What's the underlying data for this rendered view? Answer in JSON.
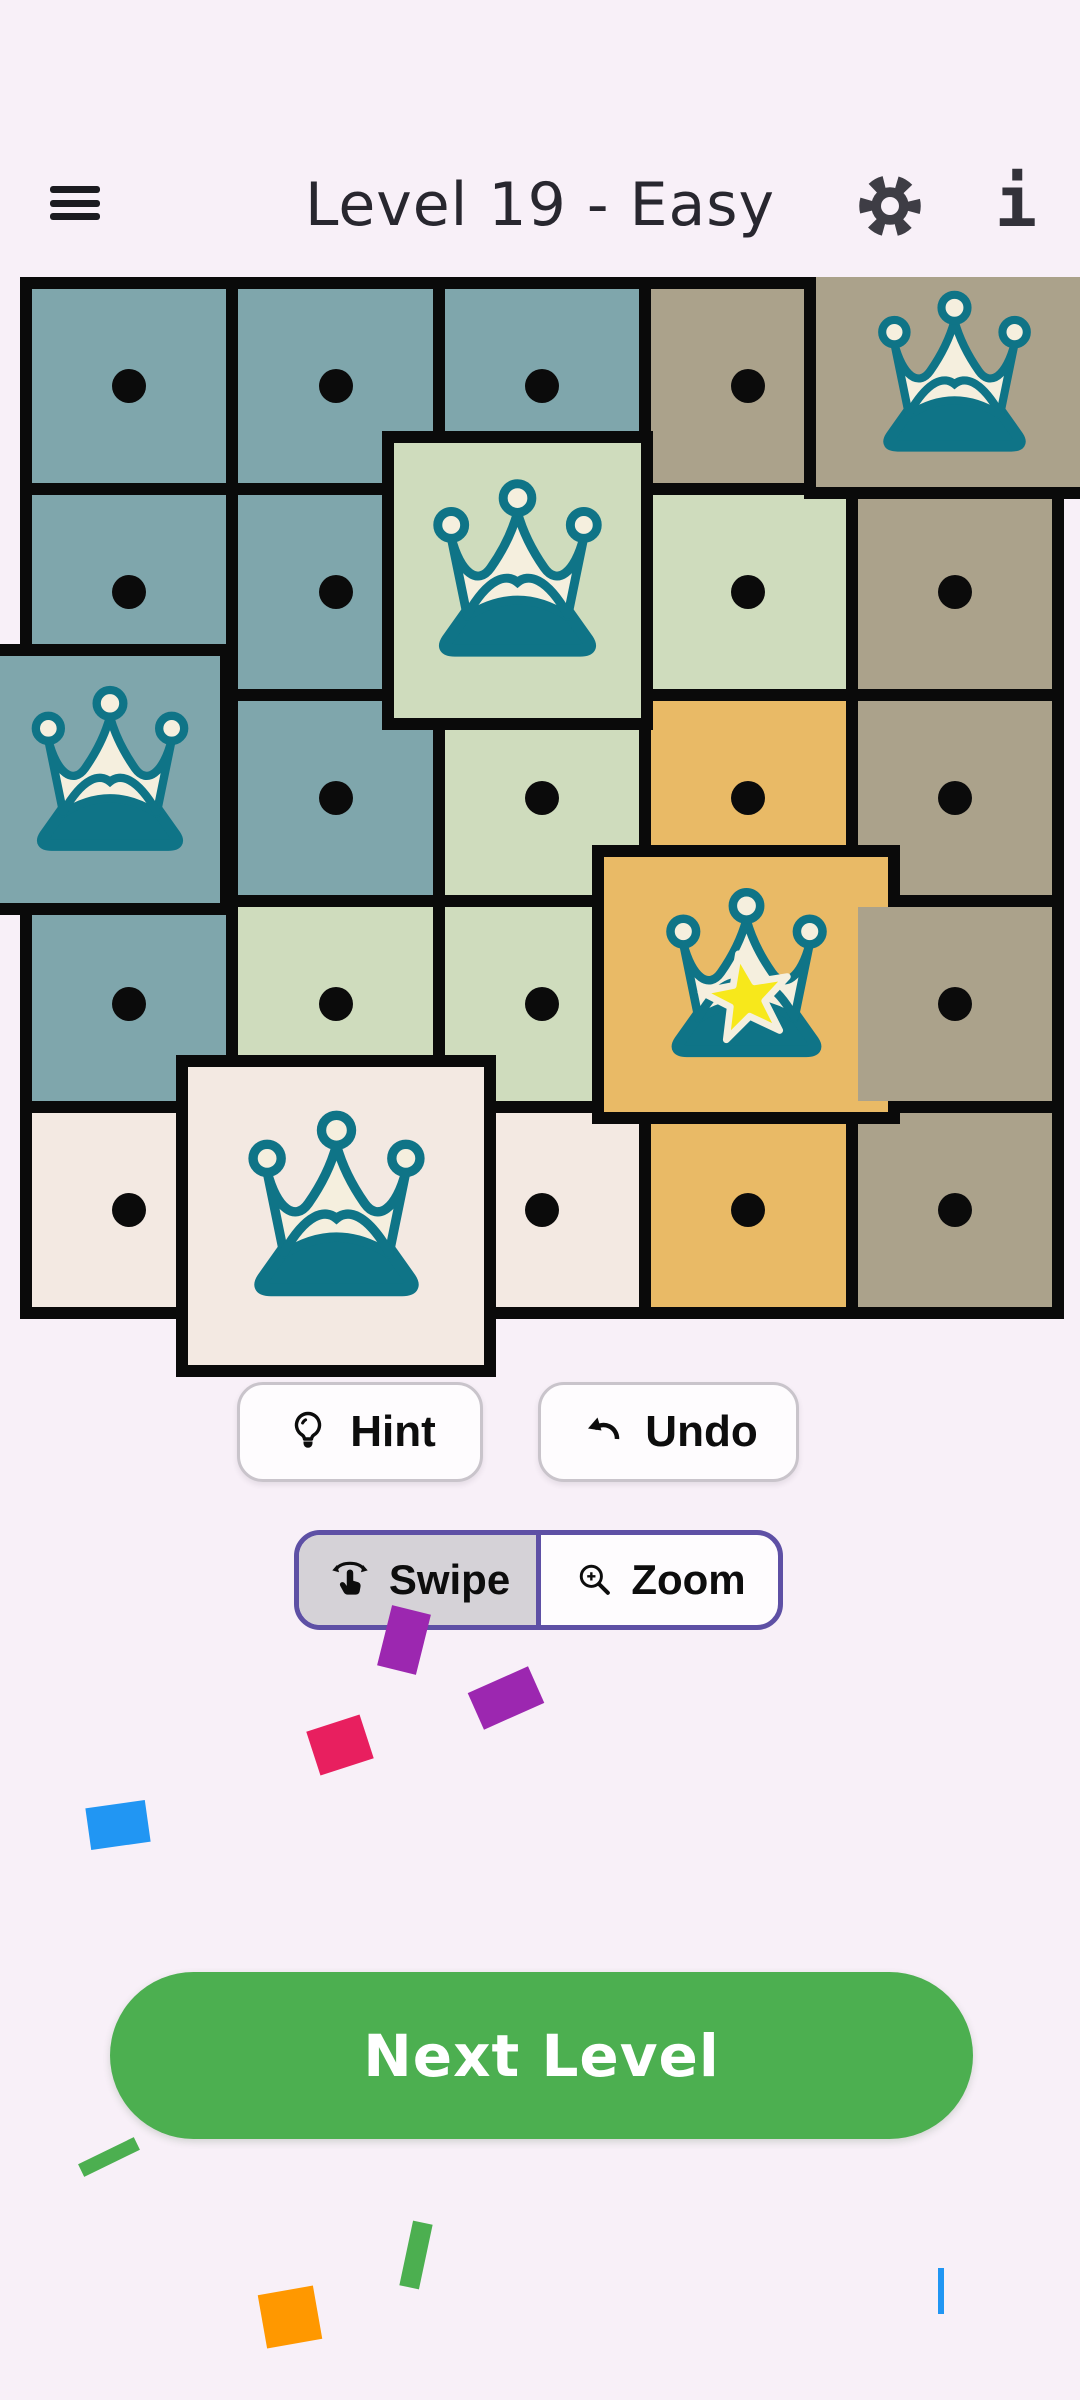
{
  "header": {
    "title": "Level 19 - Easy",
    "menu_icon": "hamburger-icon",
    "settings_icon": "gear-icon",
    "info_icon": "info-icon",
    "info_glyph": "i"
  },
  "theme": {
    "background": "#F8F0F8",
    "board_black": "#0A0A0A",
    "icon_teal": "#0F7487",
    "icon_cream": "#F5EFDE",
    "star_yellow": "#F7E81B",
    "cell_colors": {
      "blue": "#7FA6AC",
      "green": "#CFDCBD",
      "taupe": "#ABA28B",
      "orange": "#E9BA66",
      "cream": "#F3E9E2"
    }
  },
  "board": {
    "rows": 5,
    "cols": 5,
    "cells": [
      {
        "r": 0,
        "c": 0,
        "color": "blue",
        "marker": "dot"
      },
      {
        "r": 0,
        "c": 1,
        "color": "blue",
        "marker": "dot"
      },
      {
        "r": 0,
        "c": 2,
        "color": "blue",
        "marker": "dot"
      },
      {
        "r": 0,
        "c": 3,
        "color": "taupe",
        "marker": "dot"
      },
      {
        "r": 0,
        "c": 4,
        "color": "taupe",
        "marker": "crown"
      },
      {
        "r": 1,
        "c": 0,
        "color": "blue",
        "marker": "dot"
      },
      {
        "r": 1,
        "c": 1,
        "color": "blue",
        "marker": "dot"
      },
      {
        "r": 1,
        "c": 2,
        "color": "green",
        "marker": "crown"
      },
      {
        "r": 1,
        "c": 3,
        "color": "green",
        "marker": "dot"
      },
      {
        "r": 1,
        "c": 4,
        "color": "taupe",
        "marker": "dot"
      },
      {
        "r": 2,
        "c": 0,
        "color": "blue",
        "marker": "crown"
      },
      {
        "r": 2,
        "c": 1,
        "color": "blue",
        "marker": "dot"
      },
      {
        "r": 2,
        "c": 2,
        "color": "green",
        "marker": "dot"
      },
      {
        "r": 2,
        "c": 3,
        "color": "orange",
        "marker": "dot"
      },
      {
        "r": 2,
        "c": 4,
        "color": "taupe",
        "marker": "dot"
      },
      {
        "r": 3,
        "c": 0,
        "color": "blue",
        "marker": "dot"
      },
      {
        "r": 3,
        "c": 1,
        "color": "green",
        "marker": "dot"
      },
      {
        "r": 3,
        "c": 2,
        "color": "green",
        "marker": "dot"
      },
      {
        "r": 3,
        "c": 3,
        "color": "orange",
        "marker": "crown"
      },
      {
        "r": 3,
        "c": 4,
        "color": "taupe",
        "marker": "dot",
        "z": 3
      },
      {
        "r": 4,
        "c": 0,
        "color": "cream",
        "marker": "dot"
      },
      {
        "r": 4,
        "c": 1,
        "color": "cream",
        "marker": "crown"
      },
      {
        "r": 4,
        "c": 2,
        "color": "cream",
        "marker": "dot"
      },
      {
        "r": 4,
        "c": 3,
        "color": "orange",
        "marker": "dot"
      },
      {
        "r": 4,
        "c": 4,
        "color": "taupe",
        "marker": "dot"
      }
    ],
    "crown_tiles": [
      {
        "region": "taupe",
        "color": "taupe",
        "x": 804,
        "y": 277,
        "w": 288,
        "h": 222,
        "borders": "lb",
        "icon": 195,
        "star": false
      },
      {
        "region": "green",
        "color": "green",
        "x": 382,
        "y": 431,
        "w": 271,
        "h": 299,
        "borders": "all",
        "icon": 215,
        "star": false
      },
      {
        "region": "blue",
        "color": "blue",
        "x": 0,
        "y": 644,
        "w": 232,
        "h": 271,
        "borders": "trb",
        "icon": 200,
        "star": false
      },
      {
        "region": "orange",
        "color": "orange",
        "x": 592,
        "y": 845,
        "w": 308,
        "h": 279,
        "borders": "all",
        "icon": 205,
        "star": true
      },
      {
        "region": "cream",
        "color": "cream",
        "x": 176,
        "y": 1055,
        "w": 320,
        "h": 322,
        "borders": "all",
        "icon": 225,
        "star": false
      }
    ]
  },
  "toolbar": {
    "hint_label": "Hint",
    "undo_label": "Undo",
    "swipe_label": "Swipe",
    "zoom_label": "Zoom",
    "selected_mode": "Swipe"
  },
  "next_level": {
    "label": "Next Level",
    "color": "#4CAF50"
  },
  "confetti": [
    {
      "x": 384,
      "y": 1609,
      "w": 40,
      "h": 62,
      "rot": 14,
      "color": "#9C27B0"
    },
    {
      "x": 473,
      "y": 1678,
      "w": 66,
      "h": 40,
      "rot": -24,
      "color": "#9C27B0"
    },
    {
      "x": 312,
      "y": 1722,
      "w": 56,
      "h": 46,
      "rot": -18,
      "color": "#E81F5F"
    },
    {
      "x": 88,
      "y": 1804,
      "w": 60,
      "h": 42,
      "rot": -8,
      "color": "#2196F3"
    },
    {
      "x": 78,
      "y": 2150,
      "w": 62,
      "h": 14,
      "rot": -26,
      "color": "#4CAF50"
    },
    {
      "x": 406,
      "y": 2222,
      "w": 20,
      "h": 66,
      "rot": 12,
      "color": "#4CAF50"
    },
    {
      "x": 262,
      "y": 2290,
      "w": 56,
      "h": 54,
      "rot": -10,
      "color": "#FF9800"
    },
    {
      "x": 938,
      "y": 2268,
      "w": 6,
      "h": 46,
      "rot": 0,
      "color": "#2196F3"
    }
  ]
}
